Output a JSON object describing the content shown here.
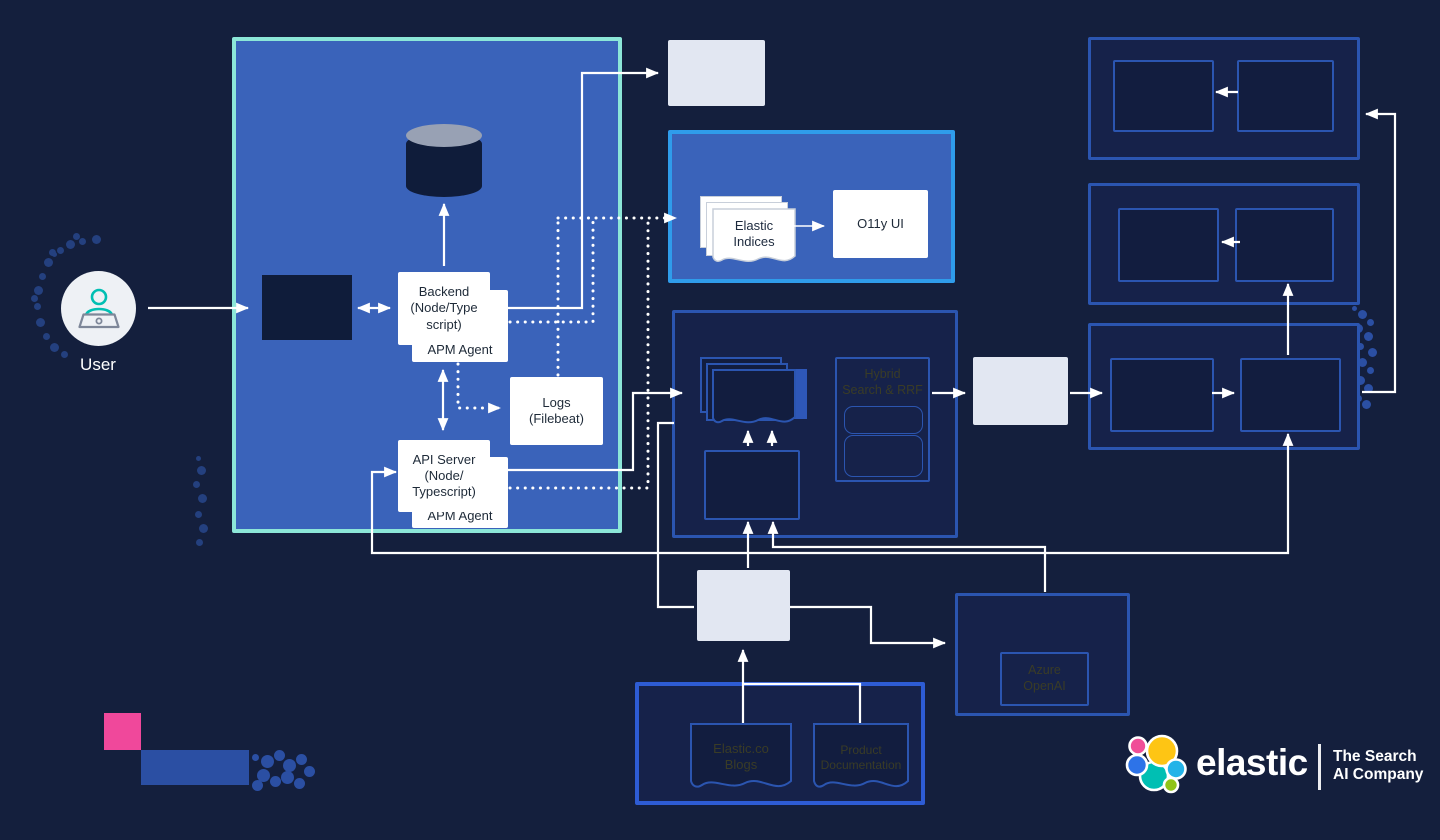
{
  "diagram": {
    "user": {
      "label": "User"
    },
    "k8s": {
      "title": "Shared\nKubernetes\nInfrastructure",
      "backend_label": "Backend\n(Node/Type\nscript)",
      "backend_agent_label": "APM Agent",
      "api_server_label": "API Server\n(Node/\nTypescript)",
      "api_agent_label": "APM Agent",
      "logs_label": "Logs\n(Filebeat)"
    },
    "es_service": {
      "title": "Elasticsearch Service\n(Observability)",
      "indices_label": "Elastic\nIndices",
      "o11y_label": "O11y UI"
    },
    "search": {
      "hybrid_label": "Hybrid\nSearch & RRF"
    },
    "azure": {
      "label": "Azure\nOpenAI"
    },
    "sources": {
      "blogs_label": "Elastic.co\nBlogs",
      "product_docs_label": "Product\nDocumentation"
    }
  },
  "branding": {
    "brand": "elastic",
    "tagline": "The Search\nAI Company"
  },
  "colors": {
    "background": "#141f3d",
    "k8s_fill": "#3a63ba",
    "k8s_border": "#8ce6d8",
    "es_border": "#2f9ceb",
    "box_border_blue": "#2b55b0",
    "sources_border": "#2e5cd4",
    "accent_pink": "#f0489b",
    "white_box": "#e2e7f2",
    "line_white": "#ffffff",
    "logo_yellow": "#fec514",
    "logo_pink": "#f04e98",
    "logo_teal": "#00bfb3",
    "logo_blue": "#2d73e8",
    "logo_cyan": "#24b3e8",
    "logo_green": "#90c418"
  }
}
